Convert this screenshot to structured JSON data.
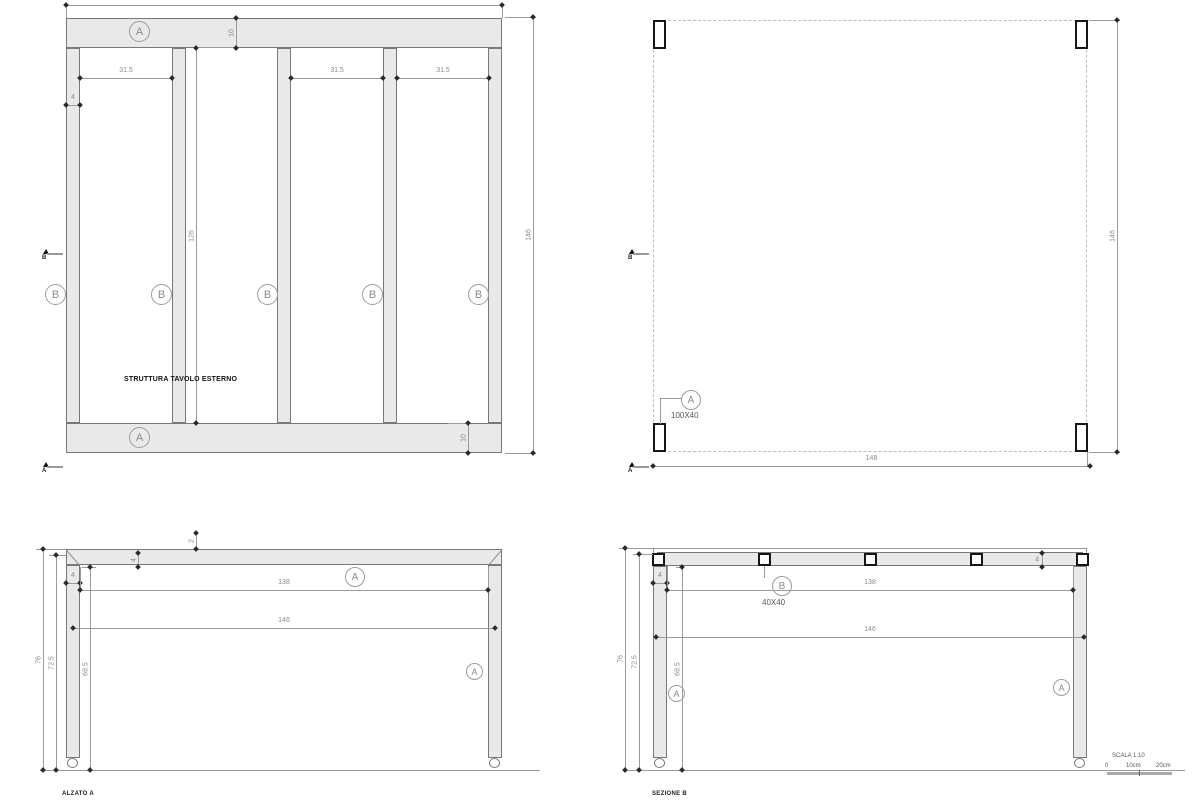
{
  "drawing": {
    "plan_frame": {
      "caption": "STRUTTURA TAVOLO ESTERNO",
      "label_rail_top": "A",
      "label_rail_bottom": "A",
      "labels_batten": [
        "B",
        "B",
        "B",
        "B",
        "B"
      ],
      "dim_overall_width": "148",
      "dim_overall_depth": "146",
      "dim_rail_top": "10",
      "dim_rail_bottom": "10",
      "dim_batten_width": "4",
      "dim_clear_depth": "126",
      "dim_bays": [
        "31.5",
        "31.5",
        "31.5"
      ]
    },
    "plan_top": {
      "label_leg": "A",
      "leg_size": "100X40",
      "dim_overall_width": "148",
      "dim_overall_depth": "146"
    },
    "elevation_a": {
      "caption": "ALZATO A",
      "label_top": "A",
      "label_leg": "A",
      "dim_top_thickness": "2",
      "dim_batten_height": "4",
      "dim_leg_width": "4",
      "dim_inner_width": "138",
      "dim_outer_width": "146",
      "dim_total_height": "76",
      "dim_leg_height": "72.5",
      "dim_clear_height": "68.5"
    },
    "section_b": {
      "caption": "SEZIONE B",
      "label_batten": "B",
      "batten_size": "40X40",
      "label_leg_left": "A",
      "label_leg_right": "A",
      "dim_batten_height": "4",
      "dim_leg_width": "4",
      "dim_inner_width": "138",
      "dim_outer_width": "146",
      "dim_total_height": "76",
      "dim_leg_height": "72.5",
      "dim_clear_height": "68.5"
    },
    "markers": {
      "section_a": "A",
      "section_b": "B"
    },
    "scale": {
      "label": "SCALA 1:10",
      "tick0": "0",
      "tick1": "10cm",
      "tick2": "20cm"
    }
  }
}
